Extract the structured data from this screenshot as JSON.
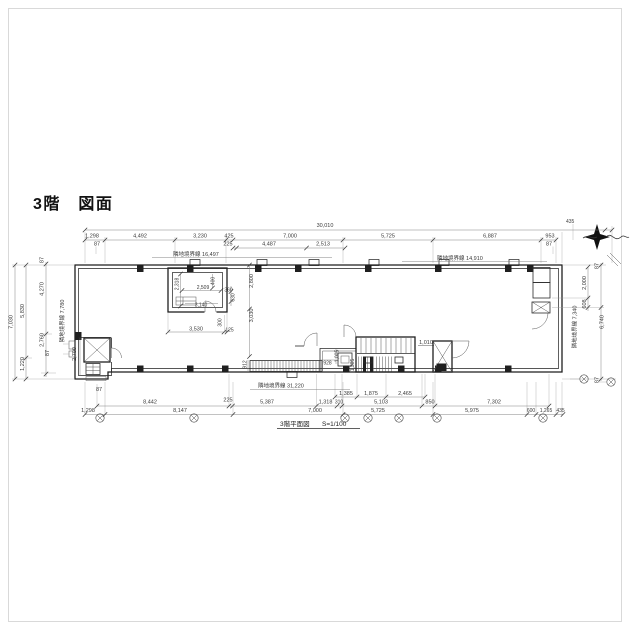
{
  "title": "3階　図面",
  "caption": {
    "name": "3階平面図",
    "scale": "S=1/100"
  },
  "boundaries": {
    "top_left": "隣地境界線 16,497",
    "top_right": "隣地境界線 14,910",
    "bottom": "隣地境界線 31,220",
    "left": "隣地境界線 7,780",
    "right": "隣地境界線 7,340"
  },
  "dims": {
    "top_overall": "30,010",
    "top_corner": "435",
    "top_row2": [
      "1,298",
      "4,492",
      "3,230",
      "425",
      "7,000",
      "5,725",
      "6,887",
      "953"
    ],
    "top_row3": [
      "87",
      "225",
      "4,487",
      "2,513",
      "87"
    ],
    "bottom_sub": [
      "1,385",
      "1,875",
      "2,465"
    ],
    "bottom_row2": [
      "8,442",
      "225",
      "5,387",
      "1,318",
      "310",
      "5,103",
      "850",
      "7,302"
    ],
    "bottom_row3": [
      "1,298",
      "8,147",
      "7,000",
      "5,725",
      "5,975",
      "600",
      "1,265",
      "435"
    ],
    "bottom_tick": "87",
    "left_total": "7,030",
    "left_mid": [
      "5,830",
      "1,220"
    ],
    "left_inner": [
      "87",
      "4,270",
      "2,760",
      "87"
    ],
    "left_wall": "2,700",
    "right_chain": [
      "87",
      "2,000",
      "608",
      "6,740",
      "87"
    ],
    "interior": {
      "room_h": "2,318",
      "room_w": "2,509",
      "room_duct": "400",
      "room_360": "360",
      "room_630": "630",
      "room_inner": "3,140",
      "room_below": "3,530",
      "room_125": "125",
      "room_300": "300",
      "mid_upper": "2,800",
      "mid_lower": "3,030",
      "strip": "912",
      "wc_w": "928",
      "wc_h": "1,005",
      "stair_side": "1,305",
      "stair_note": "1,010"
    }
  }
}
